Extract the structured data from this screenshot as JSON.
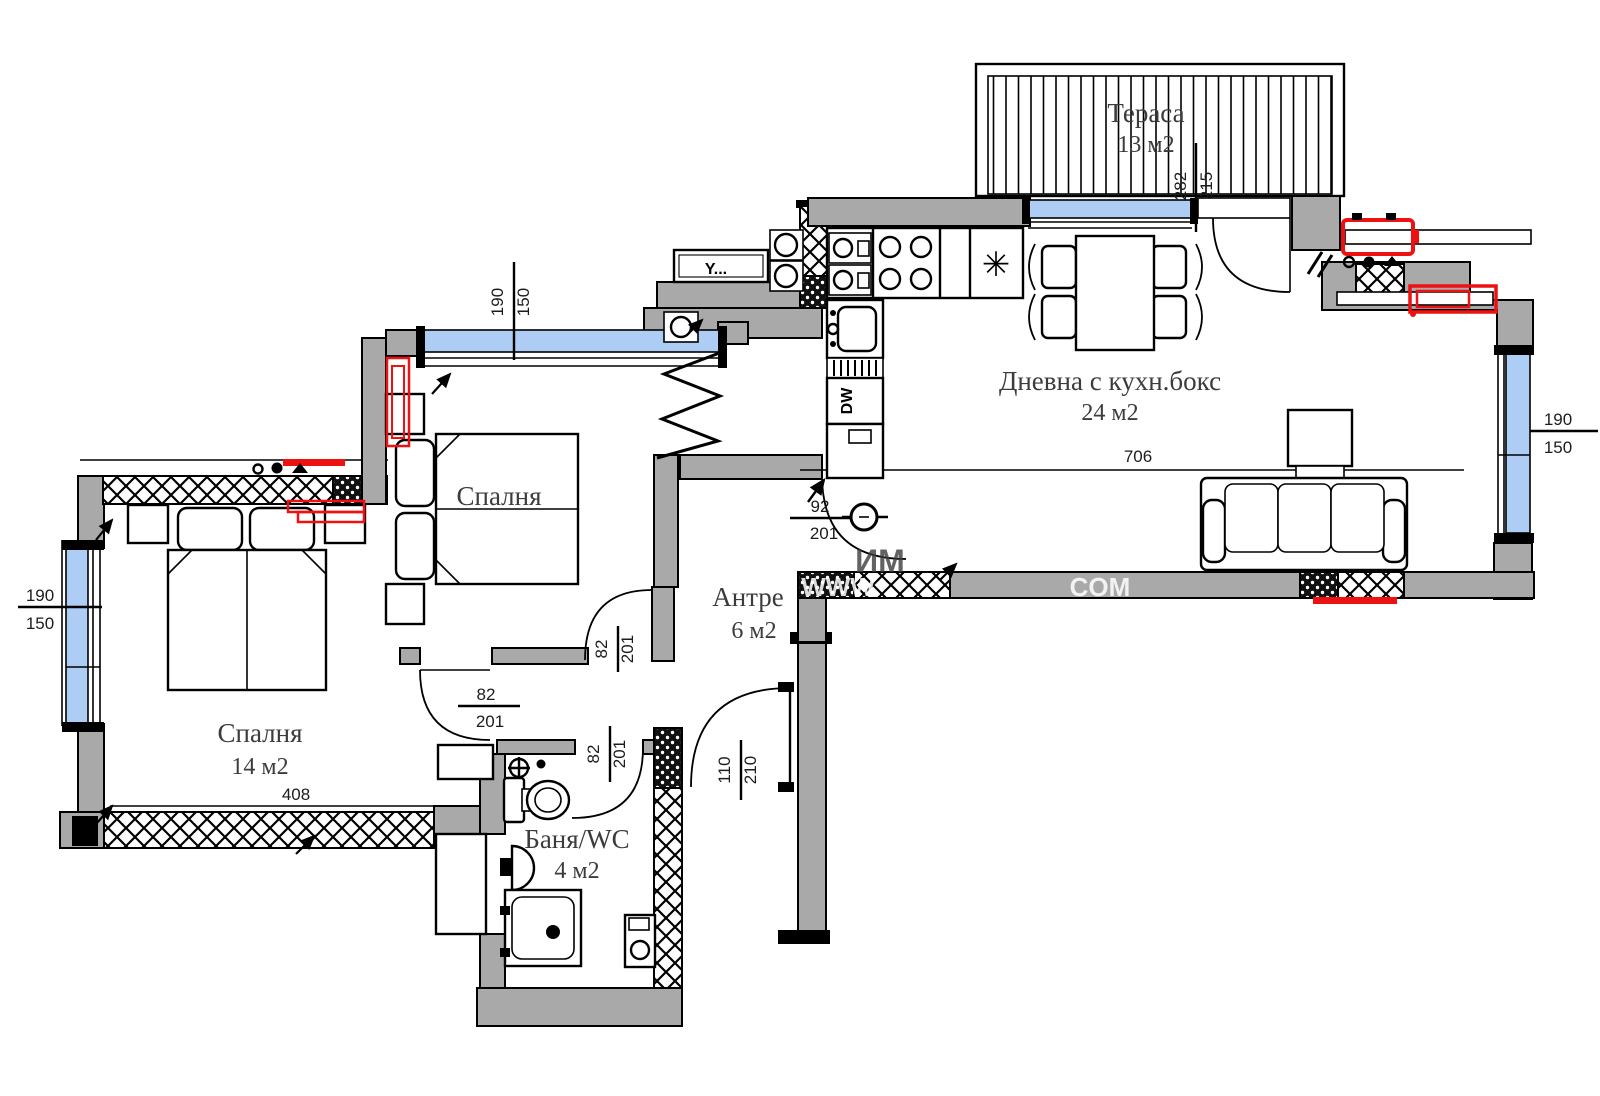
{
  "plan": {
    "rooms": {
      "terrace": {
        "name": "Тераса",
        "area": "13 м2"
      },
      "living": {
        "name": "Дневна с кухн.бокс",
        "area": "24 м2"
      },
      "bedroom1": {
        "name": "Спалня"
      },
      "bedroom2": {
        "name": "Спалня",
        "area": "14 м2"
      },
      "hall": {
        "name": "Антре",
        "area": "6 м2"
      },
      "bath": {
        "name": "Баня/WC",
        "area": "4 м2"
      }
    },
    "dimensions": {
      "window_w": "190",
      "window_h": "150",
      "terrace_w": "282",
      "terrace_h": "215",
      "entry_door_w": "92",
      "entry_door_h": "201",
      "int_door_w": "82",
      "int_door_h": "201",
      "wide_door_w": "110",
      "wide_door_h": "210",
      "living_width": "706",
      "bedroom2_width": "408"
    },
    "appliances": {
      "dishwasher": "DW",
      "electric_panel": "Y...",
      "fridge_symbol": "✳"
    },
    "watermark": {
      "fragments": [
        "WWW",
        "ИМ",
        "COM"
      ]
    },
    "colors": {
      "wall_gray": "#a9a9a9",
      "window_blue": "#aecdf4",
      "highlight_red": "#ee1111"
    }
  }
}
